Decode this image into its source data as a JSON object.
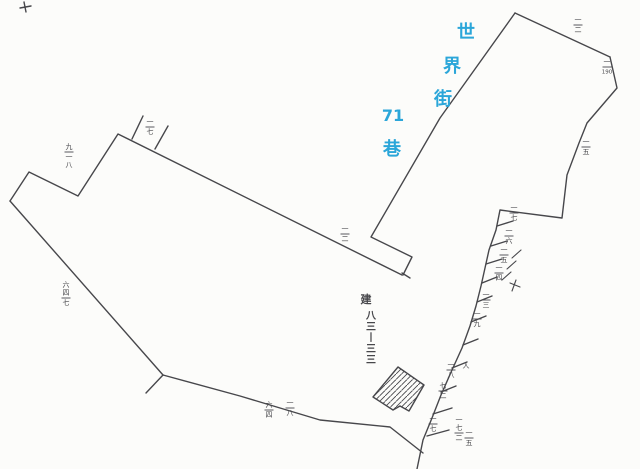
{
  "canvas": {
    "width": 640,
    "height": 469,
    "background": "#fcfcfa",
    "ink": "#47474b"
  },
  "street_label": {
    "name": "世界街71巷",
    "color": "#2ba6d9",
    "chars": [
      {
        "t": "世",
        "x": 466,
        "y": 38,
        "size": 18
      },
      {
        "t": "界",
        "x": 452,
        "y": 72,
        "size": 18
      },
      {
        "t": "街",
        "x": 443,
        "y": 105,
        "size": 18
      },
      {
        "t": "71",
        "x": 393,
        "y": 121,
        "size": 16
      },
      {
        "t": "巷",
        "x": 392,
        "y": 155,
        "size": 18
      }
    ]
  },
  "building_label": {
    "prefix": "建",
    "number": "八三-三三",
    "chars": [
      "八",
      "三",
      "丨",
      "三",
      "三"
    ],
    "x": 366,
    "y": 303,
    "col_x": 371,
    "col_y": 319,
    "step": 11
  },
  "map": {
    "polylines": [
      {
        "name": "corner-cross-v",
        "pts": [
          [
            24,
            2
          ],
          [
            26,
            12
          ]
        ]
      },
      {
        "name": "corner-cross-h",
        "pts": [
          [
            20,
            8
          ],
          [
            31,
            6
          ]
        ]
      },
      {
        "name": "west-parcel-north-chain",
        "pts": [
          [
            10,
            201
          ],
          [
            29,
            172
          ],
          [
            78,
            196
          ],
          [
            118,
            134
          ],
          [
            402,
            275
          ]
        ]
      },
      {
        "name": "west-parcel-west-edge",
        "pts": [
          [
            10,
            201
          ],
          [
            163,
            375
          ]
        ]
      },
      {
        "name": "west-parcel-south-chain",
        "pts": [
          [
            163,
            375
          ],
          [
            240,
            396
          ],
          [
            320,
            420
          ],
          [
            390,
            427
          ],
          [
            423,
            453
          ]
        ]
      },
      {
        "name": "west-parcel-spur",
        "pts": [
          [
            163,
            375
          ],
          [
            146,
            393
          ]
        ]
      },
      {
        "name": "street-boundary",
        "pts": [
          [
            515,
            13
          ],
          [
            440,
            118
          ],
          [
            371,
            237
          ],
          [
            412,
            257
          ],
          [
            403,
            275
          ]
        ]
      },
      {
        "name": "northeast-parcel-north-edge",
        "pts": [
          [
            515,
            13
          ],
          [
            610,
            57
          ]
        ]
      },
      {
        "name": "east-boundary",
        "pts": [
          [
            610,
            57
          ],
          [
            617,
            88
          ],
          [
            587,
            123
          ],
          [
            579,
            143
          ],
          [
            567,
            175
          ],
          [
            562,
            218
          ],
          [
            500,
            210
          ],
          [
            496,
            230
          ],
          [
            489,
            250
          ],
          [
            485,
            268
          ],
          [
            481,
            286
          ],
          [
            476,
            306
          ],
          [
            470,
            326
          ],
          [
            462,
            348
          ],
          [
            452,
            370
          ],
          [
            441,
            395
          ],
          [
            432,
            418
          ],
          [
            423,
            440
          ],
          [
            417,
            469
          ]
        ]
      },
      {
        "name": "tick",
        "pts": [
          [
            132,
            139
          ],
          [
            143,
            116
          ]
        ]
      },
      {
        "name": "tick",
        "pts": [
          [
            155,
            149
          ],
          [
            168,
            126
          ]
        ]
      },
      {
        "name": "tick",
        "pts": [
          [
            402,
            273
          ],
          [
            410,
            278
          ]
        ]
      },
      {
        "name": "tick",
        "pts": [
          [
            497,
            226
          ],
          [
            513,
            221
          ]
        ]
      },
      {
        "name": "tick",
        "pts": [
          [
            491,
            246
          ],
          [
            507,
            241
          ]
        ]
      },
      {
        "name": "tick",
        "pts": [
          [
            486,
            264
          ],
          [
            502,
            259
          ]
        ]
      },
      {
        "name": "tick",
        "pts": [
          [
            482,
            283
          ],
          [
            497,
            277
          ]
        ]
      },
      {
        "name": "tick",
        "pts": [
          [
            477,
            302
          ],
          [
            492,
            296
          ]
        ]
      },
      {
        "name": "tick",
        "pts": [
          [
            471,
            322
          ],
          [
            486,
            316
          ]
        ]
      },
      {
        "name": "tick",
        "pts": [
          [
            463,
            345
          ],
          [
            478,
            339
          ]
        ]
      },
      {
        "name": "tick",
        "pts": [
          [
            452,
            368
          ],
          [
            467,
            362
          ]
        ]
      },
      {
        "name": "tick",
        "pts": [
          [
            441,
            392
          ],
          [
            456,
            386
          ]
        ]
      },
      {
        "name": "tick",
        "pts": [
          [
            433,
            414
          ],
          [
            452,
            408
          ]
        ]
      },
      {
        "name": "tick",
        "pts": [
          [
            427,
            436
          ],
          [
            449,
            430
          ]
        ]
      },
      {
        "name": "scribble",
        "pts": [
          [
            512,
            258
          ],
          [
            521,
            250
          ]
        ]
      },
      {
        "name": "scribble",
        "pts": [
          [
            507,
            269
          ],
          [
            516,
            261
          ]
        ]
      },
      {
        "name": "scribble",
        "pts": [
          [
            502,
            280
          ],
          [
            511,
            272
          ]
        ]
      },
      {
        "name": "scribble",
        "pts": [
          [
            510,
            283
          ],
          [
            520,
            287
          ]
        ]
      },
      {
        "name": "scribble",
        "pts": [
          [
            516,
            280
          ],
          [
            512,
            291
          ]
        ]
      }
    ],
    "building": {
      "name": "building-83-33",
      "pts": [
        [
          398,
          367
        ],
        [
          424,
          385
        ],
        [
          409,
          411
        ],
        [
          400,
          406
        ],
        [
          393,
          410
        ],
        [
          373,
          397
        ]
      ]
    },
    "parcel_numbers": [
      {
        "x": 150,
        "y": 118,
        "top": "一",
        "bottom": "七"
      },
      {
        "x": 69,
        "y": 143,
        "top": "九",
        "bottom": "一八"
      },
      {
        "x": 578,
        "y": 16,
        "top": "一",
        "bottom": "二"
      },
      {
        "x": 607,
        "y": 58,
        "top": "一",
        "bottom": "190"
      },
      {
        "x": 586,
        "y": 138,
        "top": "一",
        "bottom": "五"
      },
      {
        "x": 345,
        "y": 225,
        "top": "一",
        "bottom": "二"
      },
      {
        "x": 514,
        "y": 204,
        "top": "一",
        "bottom": "七"
      },
      {
        "x": 509,
        "y": 227,
        "top": "一",
        "bottom": "六"
      },
      {
        "x": 504,
        "y": 246,
        "top": "一",
        "bottom": "五"
      },
      {
        "x": 499,
        "y": 264,
        "top": "一",
        "bottom": "四"
      },
      {
        "x": 486,
        "y": 291,
        "top": "一",
        "bottom": "三"
      },
      {
        "x": 477,
        "y": 310,
        "top": "一",
        "bottom": "九"
      },
      {
        "x": 66,
        "y": 281,
        "top": "六四",
        "bottom": "七"
      },
      {
        "x": 269,
        "y": 401,
        "top": "六",
        "bottom": "四"
      },
      {
        "x": 290,
        "y": 399,
        "top": "一",
        "bottom": "八"
      },
      {
        "x": 451,
        "y": 361,
        "top": "一",
        "bottom": "八"
      },
      {
        "x": 466,
        "y": 362,
        "top": "人",
        "bottom": ""
      },
      {
        "x": 443,
        "y": 382,
        "top": "七",
        "bottom": "二"
      },
      {
        "x": 433,
        "y": 415,
        "top": "一",
        "bottom": "七"
      },
      {
        "x": 459,
        "y": 416,
        "top": "一七",
        "bottom": "二"
      },
      {
        "x": 469,
        "y": 429,
        "top": "一",
        "bottom": "五"
      }
    ]
  }
}
